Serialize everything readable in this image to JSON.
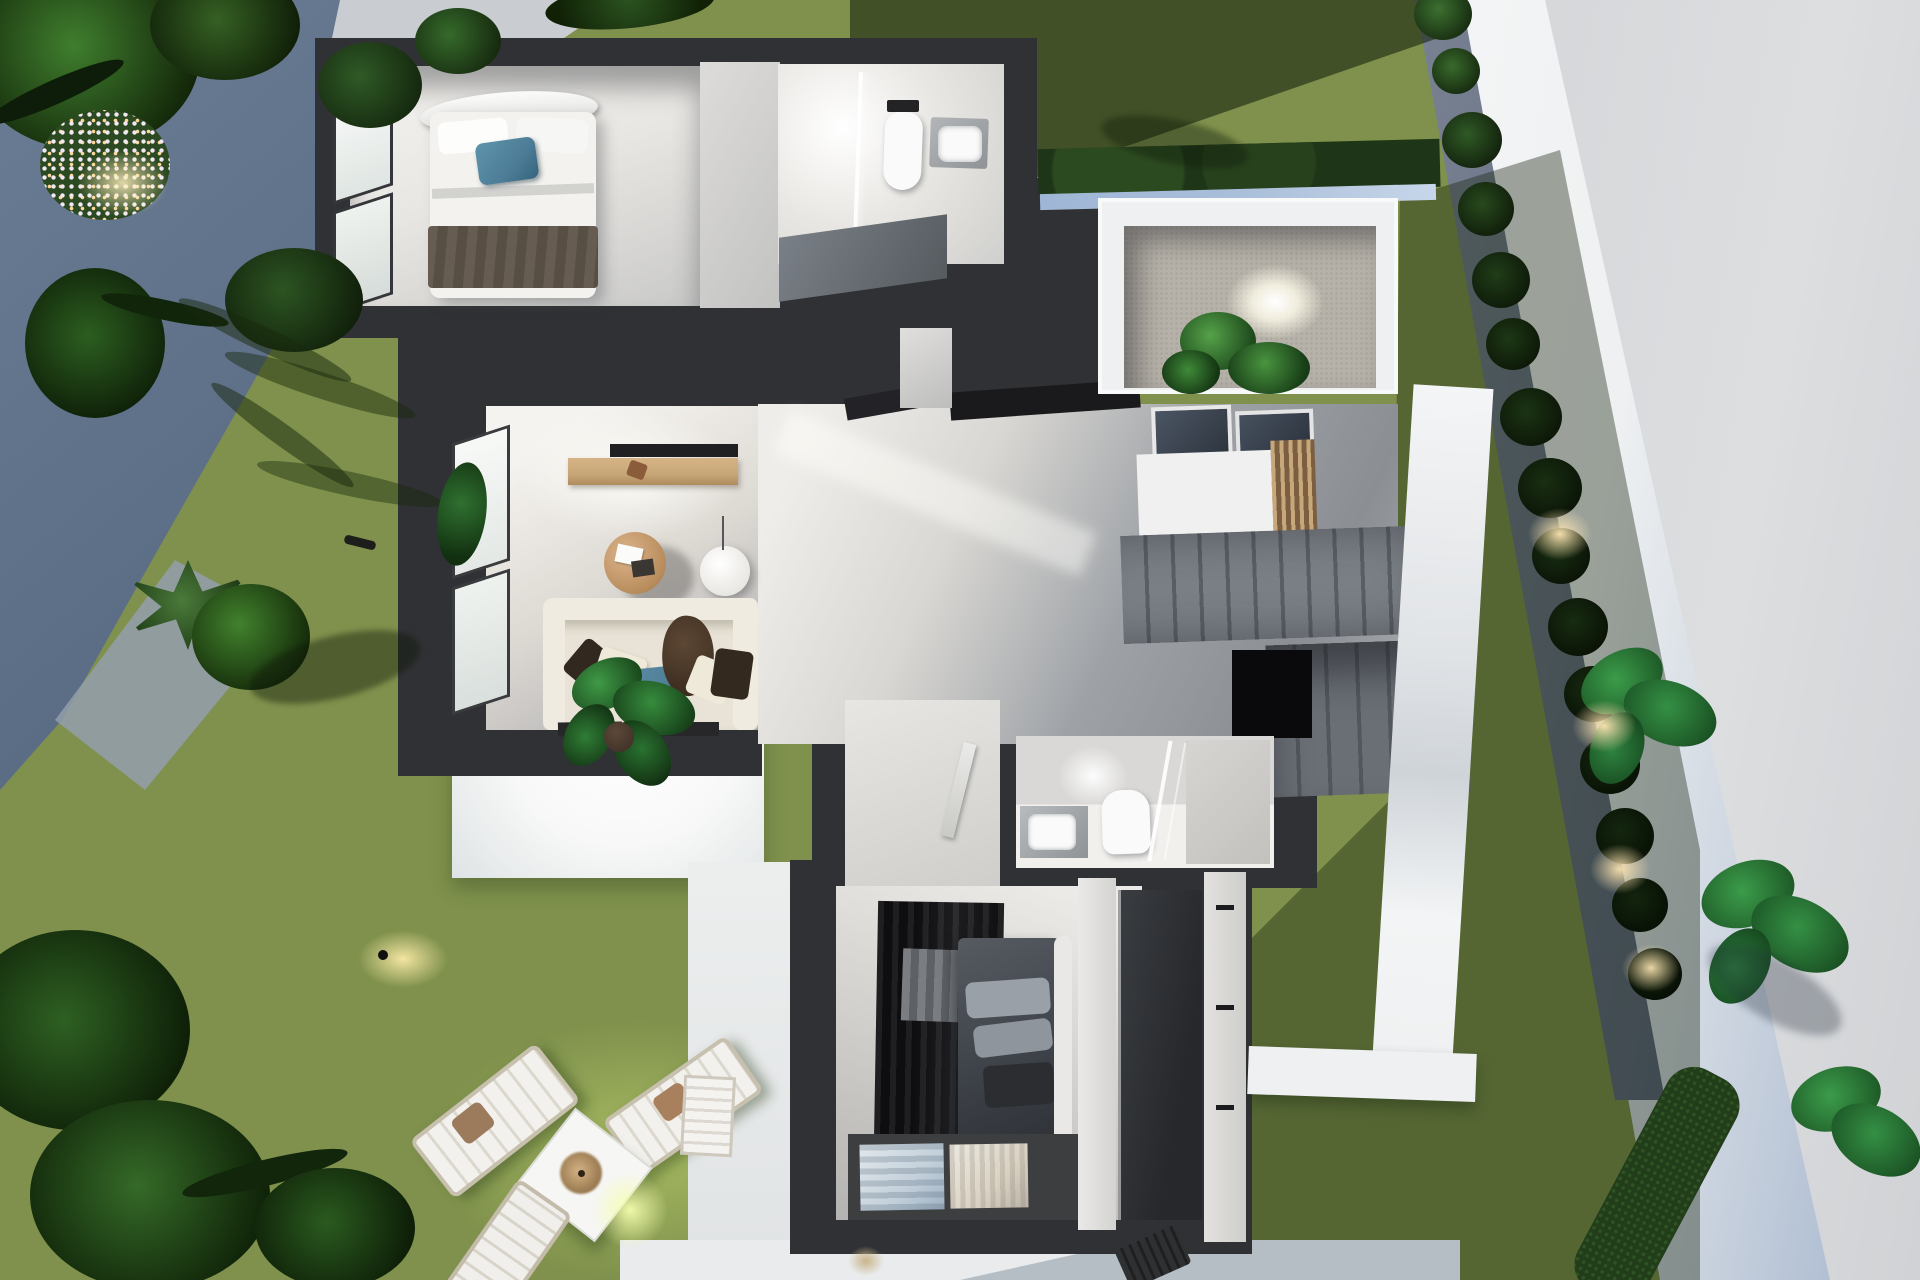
{
  "meta": {
    "description": "Top-down 3D architectural render of a modern single-storey villa cutaway floor plan at dusk, set in a landscaped garden with palm trees, lawns, cobbled path, perimeter wall and outdoor loungers",
    "view": "birds-eye-top-down",
    "visible_text": ""
  },
  "colors": {
    "wall": "#303134",
    "marble": "#e9e7e3",
    "marbleShade": "#bcbfc3",
    "floorGray": "#8d9197",
    "lawn": "#7f914c",
    "lawnBright": "#a3b95e",
    "lawnDark": "#415a2b",
    "cobble": "#5c6e86",
    "cobbleLight": "#939dac",
    "pave": "#d8dadc",
    "paveOuter": "#d2d4d7",
    "wallWhite": "#eef0f1",
    "glassBlue": "#a9bed9",
    "gravelStrip": "#7b8494",
    "gravelEntry": "#b7b2a9",
    "hedge": "#1e3617",
    "bush": "#1a2a13",
    "leaf": "#2f7a36",
    "leafDark": "#1c4a1f",
    "wood": "#c8a87a",
    "woodDark": "#7c5f41",
    "sofa": "#e8e3d6",
    "sofaLight": "#f0ebe0",
    "pillowBlue": "#4d7d97",
    "pillowBrown": "#32281f",
    "bedWhite": "#f3f2ef",
    "throw": "#665c51",
    "duvetDark": "#3f434a",
    "pillowGray": "#9aa0a7",
    "stair": "#7b8087",
    "stairDark": "#5a5f66",
    "tv": "#202023",
    "glow": "#ffe8b0",
    "pot": "#43332a",
    "void": "#0a0a0c",
    "terrace": "#f7f8f7",
    "printBlue": "#c3d0da",
    "printTan": "#d9d2c4",
    "white": "#fafafa"
  },
  "scene": {
    "site_features": [
      "street-corner-pavement",
      "cobbled-garden-path",
      "flower-bed-with-lights",
      "lawns",
      "perimeter-white-wall",
      "gravel-border-with-round-bushes",
      "entry-courtyard-gravel-spotlight",
      "palm-trees",
      "leafy-plants",
      "hedge-strip",
      "ground-spotlights",
      "wall-lights"
    ],
    "rooms": [
      {
        "name": "bedroom-1",
        "items": [
          "double-bed",
          "white-duvet",
          "blue-accent-pillow",
          "dark-throw-blanket",
          "curved-headboard",
          "corner-windows"
        ]
      },
      {
        "name": "bathroom-1",
        "items": [
          "walk-in-shower",
          "glass-screen",
          "wall-hung-toilet",
          "vanity-sink",
          "dark-counter"
        ]
      },
      {
        "name": "entry-courtyard",
        "items": [
          "hedge",
          "glass-screen",
          "gravel-bed",
          "fern-plants",
          "spotlight"
        ]
      },
      {
        "name": "living-room",
        "items": [
          "tv-wall",
          "wood-media-console",
          "round-coffee-table",
          "floor-lamp",
          "corner-sofa",
          "scatter-pillows",
          "door-mats",
          "corner-windows"
        ]
      },
      {
        "name": "hallway",
        "items": [
          "ceiling-beams",
          "skylights",
          "timber-slat-screen",
          "landing"
        ]
      },
      {
        "name": "staircase",
        "items": [
          "upper-flight",
          "lower-flight",
          "stairwell-void"
        ]
      },
      {
        "name": "bathroom-2",
        "items": [
          "vanity-sink",
          "wall-hung-toilet",
          "glass-shower-screen",
          "shower-tray",
          "open-door"
        ]
      },
      {
        "name": "bedroom-2",
        "items": [
          "open-wardrobe-hanging-clothes",
          "double-bed-dark-linen",
          "gray-pillows",
          "curved-headboard",
          "rug-with-prints",
          "built-in-closet",
          "shower-tray"
        ]
      },
      {
        "name": "terrace",
        "items": [
          "potted-plant",
          "bright-paving"
        ]
      }
    ],
    "garden_furniture": [
      "sun-lounger",
      "sun-lounger",
      "side-table-with-parasol-top",
      "sun-lounger-partial",
      "dark-lounger",
      "white-slat-chair"
    ]
  }
}
